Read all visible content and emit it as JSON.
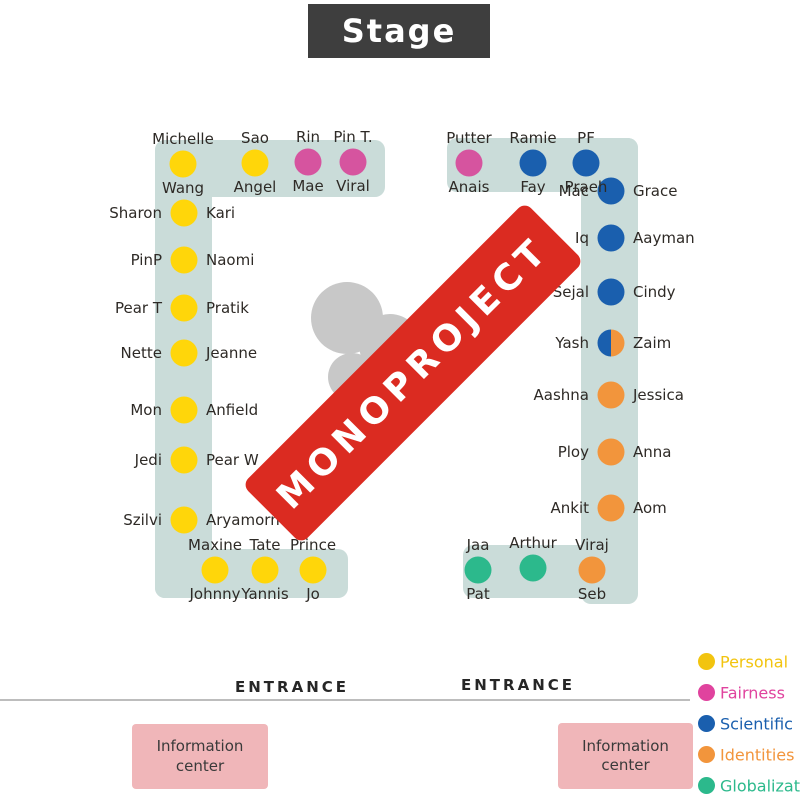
{
  "stage": {
    "label": "Stage"
  },
  "banner": {
    "text": "MONOPROJECT"
  },
  "colors": {
    "yellow": "#ffd60a",
    "pink": "#d6549f",
    "blue": "#1a5fae",
    "orange": "#f2953c",
    "green": "#2cb98c",
    "teal_band": "#cadcd9",
    "info_box_pink": "#f0b6b9",
    "stage_bg": "#3e3e3e",
    "banner_red": "#db2b21",
    "silhouette_gray": "#c8c8c8"
  },
  "sections": [
    {
      "name": "left-table-top-row",
      "orient": "h",
      "seats": [
        {
          "a": "Michelle",
          "b": "Wang",
          "color": "yellow",
          "x": 183,
          "y": 164
        },
        {
          "a": "Sao",
          "b": "Angel",
          "color": "yellow",
          "x": 255,
          "y": 163
        },
        {
          "a": "Rin",
          "b": "Mae",
          "color": "pink",
          "x": 308,
          "y": 162
        },
        {
          "a": "Pin T.",
          "b": "Viral",
          "color": "pink",
          "x": 353,
          "y": 162
        }
      ]
    },
    {
      "name": "left-table-column",
      "orient": "v",
      "seats": [
        {
          "a": "Sharon",
          "b": "Kari",
          "color": "yellow",
          "x": 184,
          "y": 213
        },
        {
          "a": "PinP",
          "b": "Naomi",
          "color": "yellow",
          "x": 184,
          "y": 260
        },
        {
          "a": "Pear T",
          "b": "Pratik",
          "color": "yellow",
          "x": 184,
          "y": 308
        },
        {
          "a": "Nette",
          "b": "Jeanne",
          "color": "yellow",
          "x": 184,
          "y": 353
        },
        {
          "a": "Mon",
          "b": "Anfield",
          "color": "yellow",
          "x": 184,
          "y": 410
        },
        {
          "a": "Jedi",
          "b": "Pear W",
          "color": "yellow",
          "x": 184,
          "y": 460
        },
        {
          "a": "Szilvi",
          "b": "Aryamorn",
          "color": "yellow",
          "x": 184,
          "y": 520
        }
      ]
    },
    {
      "name": "left-table-bottom-row",
      "orient": "h",
      "seats": [
        {
          "a": "Maxine",
          "b": "Johnny",
          "color": "yellow",
          "x": 215,
          "y": 570
        },
        {
          "a": "Tate",
          "b": "Yannis",
          "color": "yellow",
          "x": 265,
          "y": 570
        },
        {
          "a": "Prince",
          "b": "Jo",
          "color": "yellow",
          "x": 313,
          "y": 570
        }
      ]
    },
    {
      "name": "right-table-top-row",
      "orient": "h",
      "seats": [
        {
          "a": "Putter",
          "b": "Anais",
          "color": "pink",
          "x": 469,
          "y": 163
        },
        {
          "a": "Ramie",
          "b": "Fay",
          "color": "blue",
          "x": 533,
          "y": 163
        },
        {
          "a": "PF",
          "b": "Praeh",
          "color": "blue",
          "x": 586,
          "y": 163
        }
      ]
    },
    {
      "name": "right-table-column",
      "orient": "v",
      "seats": [
        {
          "a": "Mac",
          "b": "Grace",
          "color": "blue",
          "x": 611,
          "y": 191
        },
        {
          "a": "Iq",
          "b": "Aayman",
          "color": "blue",
          "x": 611,
          "y": 238
        },
        {
          "a": "Sejal",
          "b": "Cindy",
          "color": "blue",
          "x": 611,
          "y": 292
        },
        {
          "a": "Yash",
          "b": "Zaim",
          "color": "split",
          "x": 611,
          "y": 343
        },
        {
          "a": "Aashna",
          "b": "Jessica",
          "color": "orange",
          "x": 611,
          "y": 395
        },
        {
          "a": "Ploy",
          "b": "Anna",
          "color": "orange",
          "x": 611,
          "y": 452
        },
        {
          "a": "Ankit",
          "b": "Aom",
          "color": "orange",
          "x": 611,
          "y": 508
        }
      ]
    },
    {
      "name": "right-table-bottom-row",
      "orient": "h",
      "seats": [
        {
          "a": "Jaa",
          "b": "Pat",
          "color": "green",
          "x": 478,
          "y": 570
        },
        {
          "a": "Arthur",
          "b": "",
          "color": "green",
          "x": 533,
          "y": 568
        },
        {
          "a": "Viraj",
          "b": "Seb",
          "color": "orange",
          "x": 592,
          "y": 570
        }
      ]
    }
  ],
  "legend": {
    "items": [
      {
        "label": "Personal",
        "color": "#f2c40f"
      },
      {
        "label": "Fairness",
        "color": "#e0439e"
      },
      {
        "label": "Scientific",
        "color": "#1a5fae"
      },
      {
        "label": "Identities",
        "color": "#f2953c"
      },
      {
        "label": "Globalization",
        "color": "#2cb98c"
      }
    ]
  },
  "entrances": {
    "left": "ENTRANCE",
    "right": "ENTRANCE"
  },
  "info_centers": [
    {
      "line1": "Information",
      "line2": "center"
    },
    {
      "line1": "Information",
      "line2": "center"
    }
  ]
}
